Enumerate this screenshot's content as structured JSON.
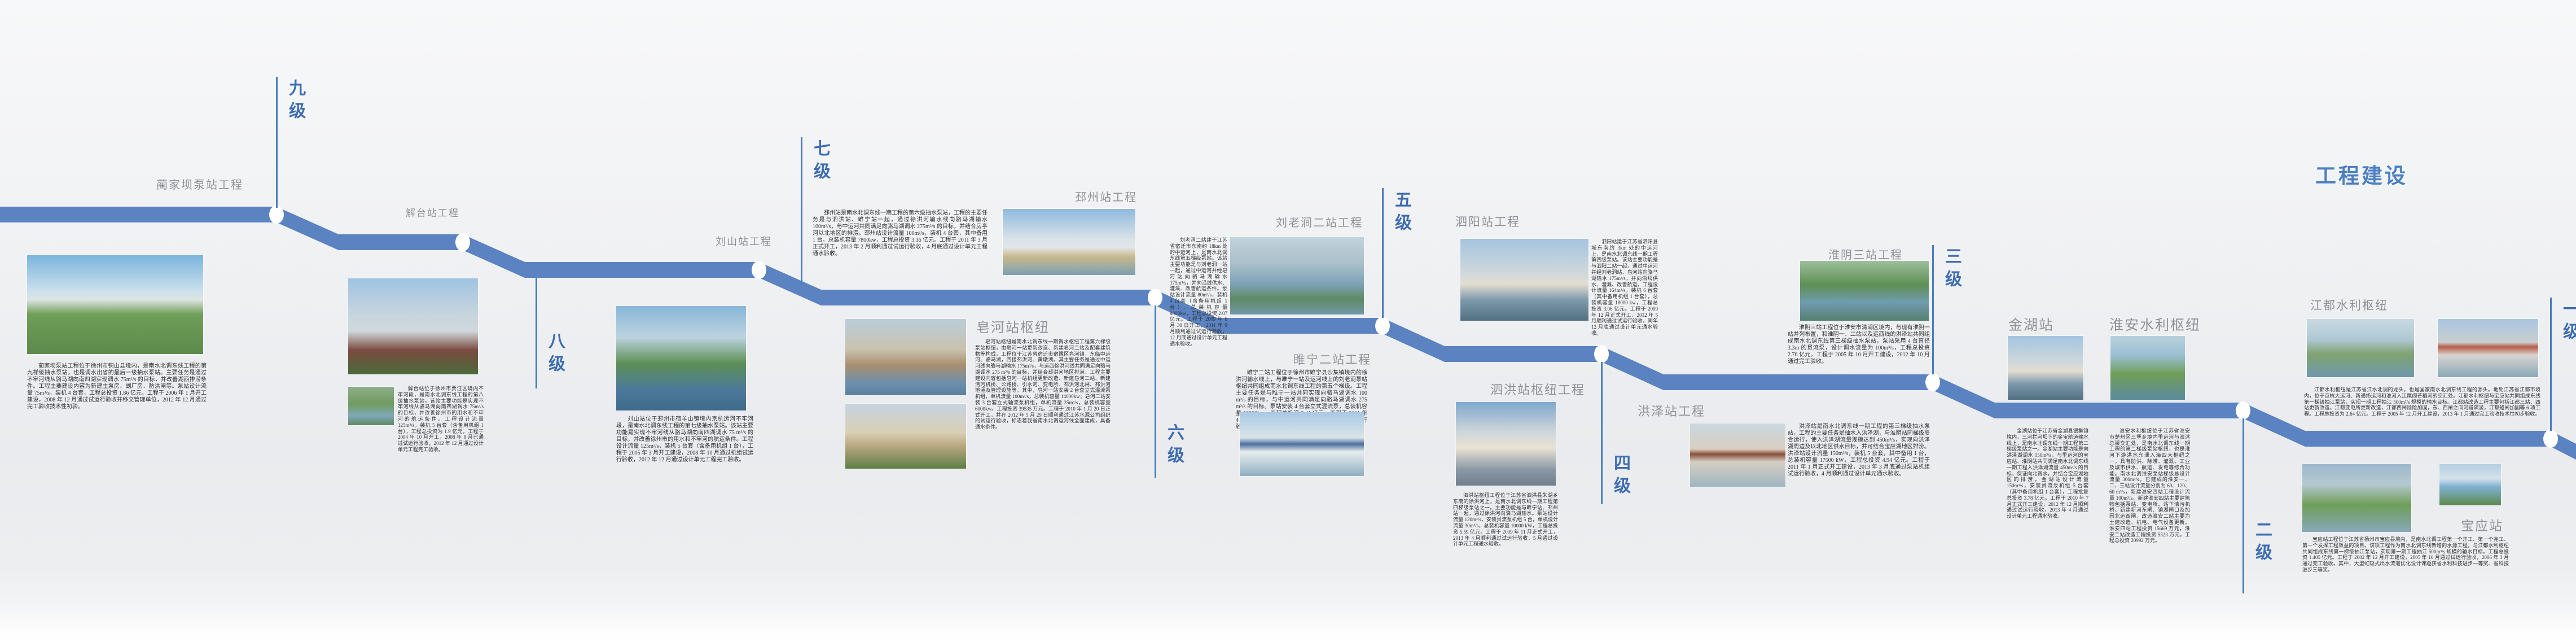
{
  "title": {
    "text": "工程建设",
    "color": "#4a7fc1"
  },
  "design": {
    "band_color": "#5b82c1",
    "dot_color": "#ffffff",
    "level_text_color": "#3d6cb1",
    "label_color": "#8d9297",
    "background": "#eef0f2"
  },
  "levels": [
    {
      "label": "九级",
      "side": "above"
    },
    {
      "label": "八级",
      "side": "below"
    },
    {
      "label": "七级",
      "side": "above"
    },
    {
      "label": "六级",
      "side": "below"
    },
    {
      "label": "五级",
      "side": "above"
    },
    {
      "label": "四级",
      "side": "below"
    },
    {
      "label": "三级",
      "side": "above"
    },
    {
      "label": "二级",
      "side": "below"
    },
    {
      "label": "一级",
      "side": "above"
    }
  ],
  "stations": [
    {
      "label": "蔺家坝泵站工程",
      "level": "九级",
      "para": "蔺家坝泵站工程位于徐州市铜山县境内，是南水北调东线工程的第九梯级抽水泵站，也是调水出省的最后一级抽水泵站。主要任务是通过不牢河线从骆马湖向南四湖实现调水 75m³/s 的目标，并改善湖西排涝条件。工程主要建设内容为新建主泵房、副厂房、防洪闸等。泵站设计流量 75m³/s，装机 4 台套，工程总投资 1.86 亿元。工程于 2006 年 1 月开工建设，2008 年 12 月通过试运行验收并移交管理单位，2012 年 12 月通过完工验收技术性初验。",
      "photos": [
        "pump-station-aerial-green-fields"
      ]
    },
    {
      "label": "解台站工程",
      "level": "八级",
      "para": "解台站位于徐州市贾汪区境内不牢河段，是南水北调东线工程的第八级抽水泵站。该站主要功能是实现不牢河线从骆马湖向南四湖调水 75m³/s 的目标，并改善徐州市的用水和不牢河的航运条件。工程设计流量 125m³/s，装机 5 台套（含备用机组 1 台），工程总投资为 1.9 亿元。工程于 2004 年 10 月开工，2008 年 8 月已通过试运行验收，2012 年 12 月通过设计单元工程完工验收。",
      "photos": [
        "station-building-red-foliage",
        "station-aerial-town"
      ]
    },
    {
      "label": "刘山站工程",
      "level": "七级",
      "para": "刘山站位于邳州市宿羊山镇境内京杭运河不牢河段，是南水北调东线工程的第七级抽水泵站。该站主要功能是实现不牢河线从骆马湖向南四湖调水 75 m³/s 的目标，并改善徐州市的用水和不牢河的航运条件。工程设计流量 125m³/s，装机 5 台套（含备用机组 1 台），工程于 2005 年 3 月开工建设，2008 年 10 月通过机组试运行验收，2012 年 12 月通过设计单元工程完工验收。",
      "photos": [
        "station-aerial-canal-junction"
      ]
    },
    {
      "label": "邳州站工程",
      "level": "六级",
      "para": "邳州站是南水北调东线一期工程的第六级抽水泵站，工程的主要任务是与泗洪站、睢宁站一起，通过徐洪河输水线向骆马湖输水 100m³/s，与中运河共同满足向骆马湖调水 275m³/s 的目标，并结合房亭河以北地区的排涝。邳州站设计流量 100m³/s，装机 4 台套，其中备用 1 台，总装机容量 7800kw，工程总投资 3.16 亿元。工程于 2011 年 3 月正式开工，2013 年 2 月顺利通过试运行验收，4 月底通过设计单元工程通水验收。",
      "photos": [
        "station-building-over-sluice"
      ]
    },
    {
      "label": "皂河站枢纽",
      "level": "六级",
      "para": "皂河站枢纽是南水北调东线一期调水枢纽工程第六梯级泵站枢纽，由皂河一站更新改造、新建皂河二站及配套建筑物等构成。工程位于江苏省宿迁市宿豫区皂河镇，东临中运河、骆马湖，西接邳洪河、黄墩湖。其主要任务是通过中运河线向骆马湖输水 175m³/s，与运西徐洪河线共同满足向骆马湖调水 275 m³/s 的目标，并结合邳洪河地区排涝。工程主要建设内容包括皂河一站机组更新改造、新建皂河二站、新建清污机桥、公路桥、引水河、变电所、邳洪河北闸、邳洪河地涵及管理设施等。其中，皂河一站安装 2 台套立式混流泵机组，单机流量 100m³/s，总装机容量 14000kw；皂河二站安装 3 台套立式轴流泵机组，单机流量 25m³/s，总装机容量 6000kw。工程投资 39535 万元。工程于 2010 年 1 月 20 日正式开工，并在 2012 年 5 月 29 日顺利通过江苏水源公司组织的试运行验收，标志着我省南水北调运河线全面建成，具备通水条件。",
      "photos": [
        "hub-construction-aerial",
        "hub-colonnade-building"
      ]
    },
    {
      "label": "刘老涧二站工程",
      "level": "五级",
      "para": "刘老涧二站建于江苏省宿迁市东南约 18km 处的中运河上，是南水北调东线第五梯级泵站。该站主要功能是与刘老涧一站一起，通过中运河并经皂河站向骆马湖输水 175m³/s，并向沿线供水、灌溉、改善航运条件。泵站设计流量 80m³/s，装机 4 台套（含备用机组 1 台），总装机容量 8000kw，工程总投资 2.07 亿元。工程于 2009 年 6 月 30 日开工，2011 年 9 月顺利通过试运行验收，12 月底通过设计单元工程通水验收。",
      "photos": [
        "station-aerial-misty-river"
      ]
    },
    {
      "label": "睢宁二站工程",
      "level": "五级",
      "para": "睢宁二站工程位于徐州市睢宁县沙集镇境内的徐洪河输水线上，与睢宁一站及运河线上的刘老涧泵站枢纽共同组成南水北调东线工程的第五个梯级。工程主要任务是与睢宁一站共同实现向骆马湖调水 100 m³/s 的目标，与中运河共同满足向骆马湖调水 275 m³/s 的目标。泵站安装 4 台套立式混流泵，总装机容量 12000kw，工程总投资 2.41 亿元。工程于 2011 年 4 月下旬正式开工建设，2013 年 4 月顺利通过试运行验收，5 月通过设计单元工程通水验收。",
      "photos": [
        "station-white-building-blue-roof"
      ]
    },
    {
      "label": "泗阳站工程",
      "level": "四级",
      "para": "泗阳站建于江苏省泗阳县城东南约 3km 处的中运河上，是南水北调东线一期工程第四级泵站。该站主要功能是与泗阳二站一起，通过中运河并经刘老涧站、皂河站向骆马湖输水 175m³/s，并向沿线供水、灌溉、改善航运。工程设计流量 164m³/s，装机 6 台套（其中备用机组 1 台套），总装机容量 18000 kw，工程总投资 3.06 亿元。工程于 2009 年 12 月正式开工，2012 年 5 月顺利通过试运行验收，同年 12 月底通过设计单元通水验收。",
      "photos": [
        "station-building-reflection"
      ]
    },
    {
      "label": "泗洪站枢纽工程",
      "level": "四级",
      "para": "泗洪站枢纽工程位于江苏省泗洪县朱湖乡东南的徐洪河上，是南水北调东线一期工程第四梯级泵站之一。主要功能是与睢宁站、邳州站一起，通过徐洪河向骆马湖输水。泵站设计流量 120m³/s，安装贯流泵机组 5 台，单机设计流量 30m³/s，总装机容量 10000 kW，工程总投资 5.59 亿元。工程于 2009 年 11 月正式开工，2013 年 4 月顺利通过试运行验收，5 月通过设计单元工程通水验收。",
      "photos": [
        "hub-building-sunset-sky"
      ]
    },
    {
      "label": "洪泽站工程",
      "level": "三级",
      "para": "洪泽站是南水北调东线一期工程的第三梯级抽水泵站，工程的主要任务是抽水入洪泽湖，与淮阴站同梯级联合运行，使入洪泽湖流量规模达到 450m³/s，实现向洪泽湖周边及以北地区供水目标，并可结合宝应湖地区排涝。洪泽站设计流量 150m³/s，装机 5 台套，其中备用 1 台，总装机容量 17500 kW，工程总投资 4.94 亿元。工程于 2011 年 1 月正式开工建设，2013 年 3 月底通过泵站机组试运行验收，4 月顺利通过设计单元通水验收。",
      "photos": [
        "palace-style-station-over-water"
      ]
    },
    {
      "label": "淮阴三站工程",
      "level": "三级",
      "para": "淮阴三站工程位于淮安市清浦区境内，与现有淮阴一站并列布置，和淮阴一、二站以及运西线的洪泽站共同组成南水北调东线第三梯级抽水泵站。泵站采用 4 台直径 3.3m 的贯流泵，设计调水流量为 100m³/s，工程总投资 2.76 亿元。工程于 2005 年 10 月开工建设，2012 年 10 月通过完工验收。",
      "photos": [
        "station-aerial-green-waterways"
      ]
    },
    {
      "label": "金湖站",
      "level": "二级",
      "para": "金湖站位于江苏省金湖县银集镇境内，三河拦河坝下的金宝航道输水线上，是南水北调东线一期工程第二梯级泵站之一。金湖站主要功能是向洪泽湖调水 150m³/s，与里运河的宝应站、淮阴站共同满足南水北调东线一期工程入洪泽湖流量 450m³/s 的目标，保证向北调水，并结合宝应湖地区的排涝。金湖站设计流量 150m³/s，安装贯流泵机组 5 台套（其中备用机组 1 台套），工程批复总投资 3.78 亿元。工程于 2010 年 7 月正式开工建设，2012 年 12 月顺利通过试运行验收，2013 年 4 月通过设计单元工程通水验收。",
      "photos": [
        "station-building-water-reflection"
      ]
    },
    {
      "label": "淮安水利枢纽",
      "level": "二级",
      "para": "淮安水利枢纽位于江苏省淮安市楚州区三堡乡境内里运河与淮沭总渠交汇处，是南水北调东线一期工程的第二梯级泵站枢纽，也是淮河下游洪水东泄入海四大枢纽之一，具有防洪、除涝、灌溉、工业及城市供水、航运、发电等综合功能。南水北调淮安泵站梯级总设计流量 300m³/s，已建成的淮安一、二、三站设计流量分别为 60、120、60 m³/s，新建淮安四站工程设计流量 100m³/s。新建淮安四站主要建筑物包括泵站、变电所、站下清污机桥、新建新河东闸、镇湖闸口及加固北运西闸，改造淮安二站主要为土建改造、机电、电气设备更新。淮安四站工程投资 15669 万元，淮安二站改造工程投资 5323 万元，工程总投资 20992 万元。",
      "photos": [
        "hub-aerial-green-waterways"
      ]
    },
    {
      "label": "江都水利枢纽",
      "level": "一级",
      "para": "江都水利枢纽是江苏省江水北调的龙头，也是国家南水北调东线工程的源头。地处江苏省江都市境内，位于京杭大运河、新通扬运河和淮河入江尾闾芒稻河的交汇处。江都水利枢纽与宝应站共同组成东线第一梯级抽江泵站，实现一期工程抽江 500m³/s 规模的输水目标。江都站改造工程主要包括江都三站、四站更新改造，江都变电所更新改造，江都西闸除险加固，东、西闸之间河道疏浚，江都船闸加固等 6 项工程。工程总投资为 2.64 亿元。工程于 2005 年 12 月开工建设，2013 年 1 月通过完工验收技术性初步验收。",
      "photos": [
        "hub-aerial-lake-islands",
        "red-roof-station-over-dam"
      ]
    },
    {
      "label": "宝应站",
      "level": "一级",
      "para": "宝应站工程位于江苏省扬州市宝应县境内，是南水北调工程第一个开工、第一个完工、第一个发挥工程效益的项目。该项工程作为南水北调东线新增的水源工程，与江都水利枢纽共同组成东线第一梯级抽江泵站，实现第一期工程抽江 500m³/s 规模的输水目标。工程总投资 1.405 亿元。工程于 2002 年 12 月开工建设，2005 年 10 月通过试运行验收，2006 年 3 月通过完工验收。其中，大型虹吸式出水流道优化设计课题获省水利科技进步一等奖、省科技进步三等奖。",
      "photos": [
        "station-aerial-campus",
        "blue-station-building-field"
      ]
    }
  ]
}
